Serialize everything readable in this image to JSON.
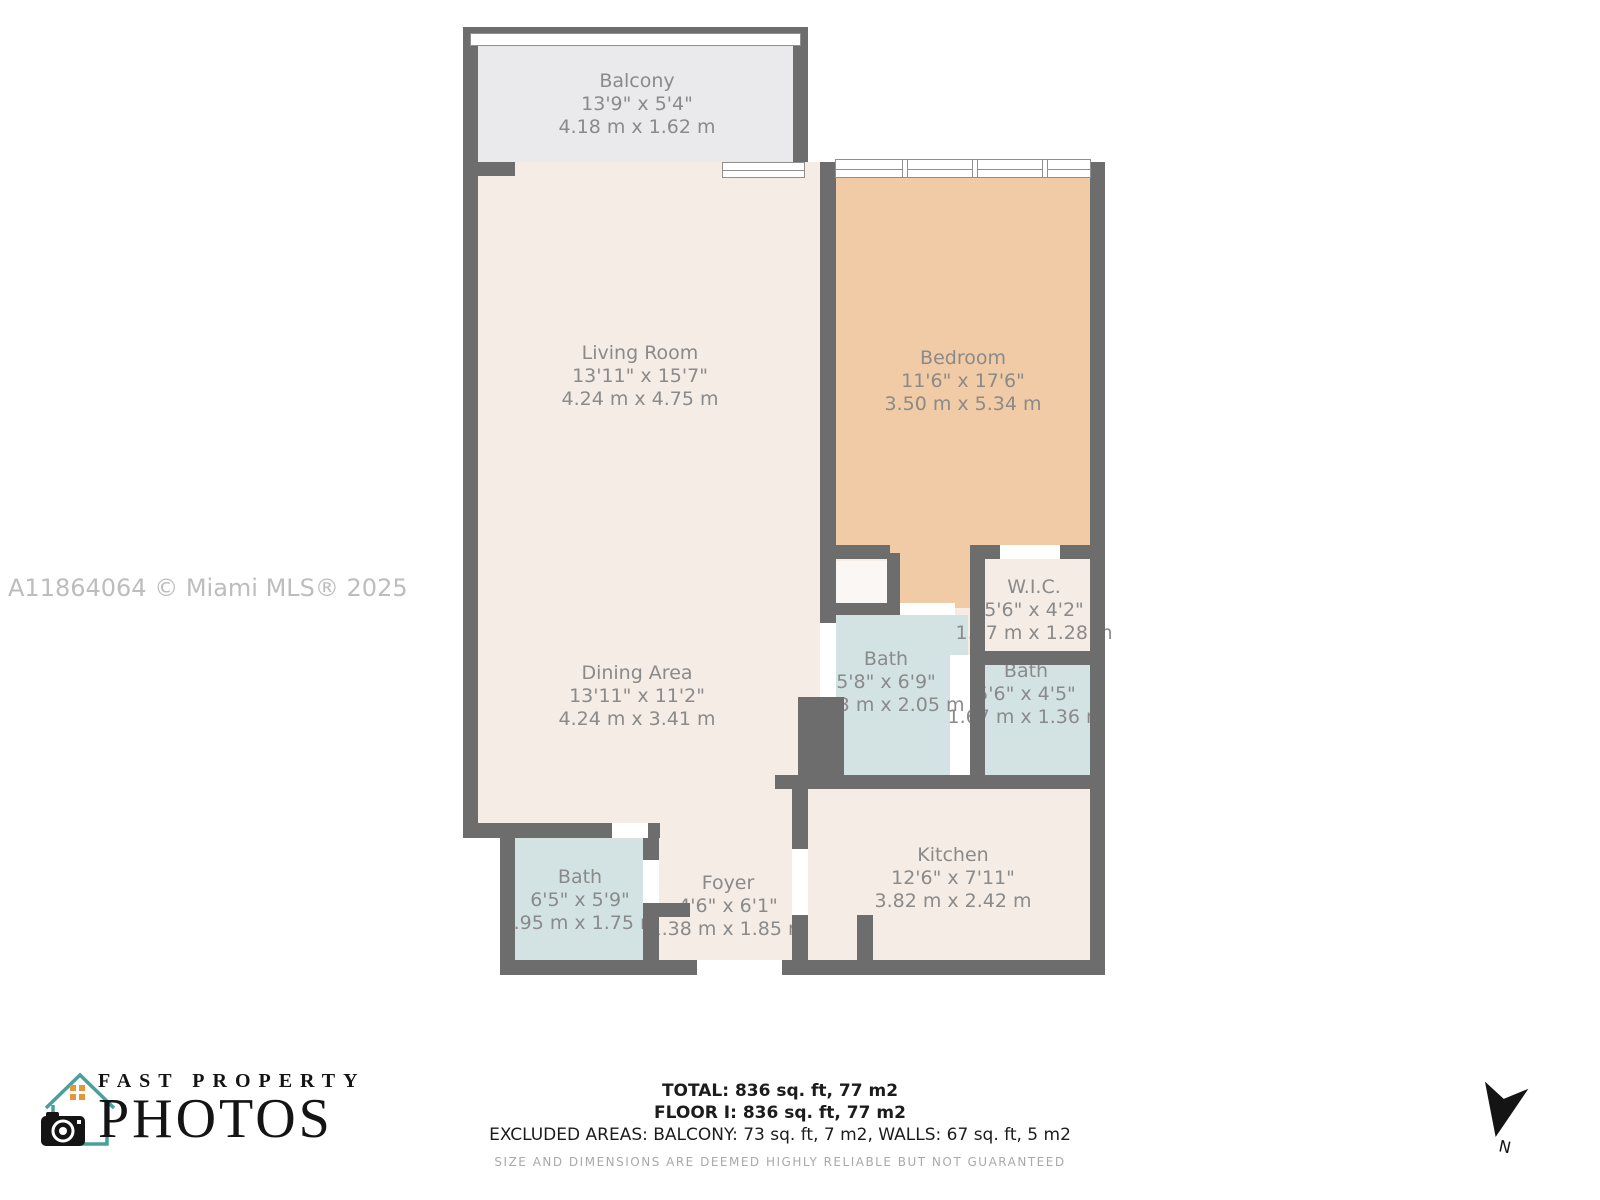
{
  "watermark": "A11864064 © Miami MLS® 2025",
  "rooms": {
    "balcony": {
      "name": "Balcony",
      "imperial": "13'9\" x 5'4\"",
      "metric": "4.18 m x 1.62 m"
    },
    "living_room": {
      "name": "Living Room",
      "imperial": "13'11\" x 15'7\"",
      "metric": "4.24 m x 4.75 m"
    },
    "bedroom": {
      "name": "Bedroom",
      "imperial": "11'6\" x 17'6\"",
      "metric": "3.50 m x 5.34 m"
    },
    "wic": {
      "name": "W.I.C.",
      "imperial": "5'6\" x 4'2\"",
      "metric": "1.67 m x 1.28 m"
    },
    "bath_center": {
      "name": "Bath",
      "imperial": "5'8\" x 6'9\"",
      "metric": "1.73 m x 2.05 m"
    },
    "bath_right": {
      "name": "Bath",
      "imperial": "5'6\" x 4'5\"",
      "metric": "1.67 m x 1.36 m"
    },
    "dining_area": {
      "name": "Dining Area",
      "imperial": "13'11\" x 11'2\"",
      "metric": "4.24 m x 3.41 m"
    },
    "bath_lower": {
      "name": "Bath",
      "imperial": "6'5\" x 5'9\"",
      "metric": "1.95 m x 1.75 m"
    },
    "foyer": {
      "name": "Foyer",
      "imperial": "4'6\" x 6'1\"",
      "metric": "1.38 m x 1.85 m"
    },
    "kitchen": {
      "name": "Kitchen",
      "imperial": "12'6\" x 7'11\"",
      "metric": "3.82 m x 2.42 m"
    }
  },
  "footer": {
    "total": "TOTAL: 836 sq. ft, 77 m2",
    "floor": "FLOOR I: 836 sq. ft, 77 m2",
    "excluded": "EXCLUDED AREAS: BALCONY: 73 sq. ft, 7 m2, WALLS: 67 sq. ft, 5 m2",
    "disclaimer": "SIZE AND DIMENSIONS ARE DEEMED HIGHLY RELIABLE BUT NOT GUARANTEED"
  },
  "logo": {
    "line1": "FAST PROPERTY",
    "line2": "PHOTOS"
  },
  "compass": {
    "label": "N"
  },
  "colors": {
    "wall": "#6d6d6d",
    "floor_cream": "#f5ece5",
    "floor_bedroom": "#f1cba6",
    "floor_bath": "#d3e3e3",
    "floor_balcony": "#eaeaec",
    "label_text": "#8a8a8a",
    "watermark_text": "#bdbdbd",
    "logo_teal": "#4aa09a",
    "logo_orange": "#e5953a"
  }
}
